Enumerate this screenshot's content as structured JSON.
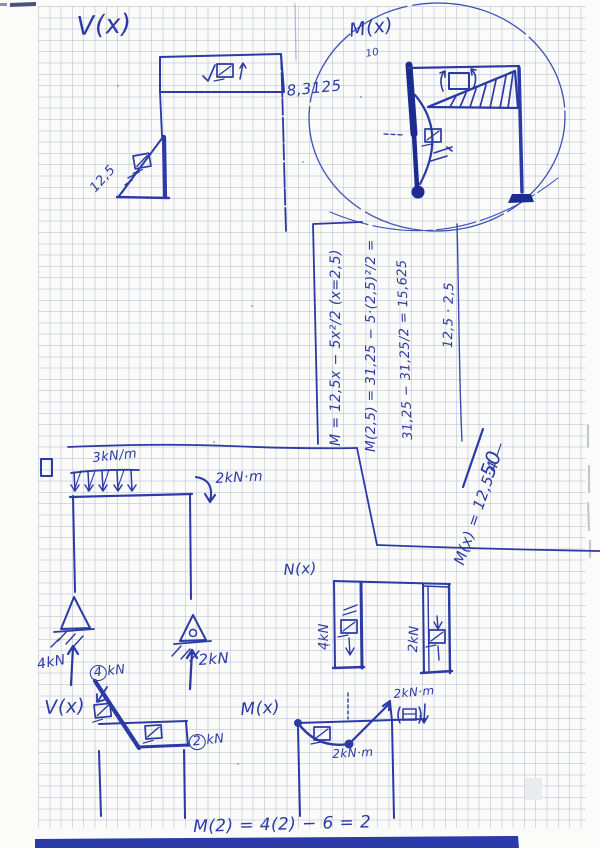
{
  "colors": {
    "ink": "#2b3aa5",
    "ink_heavy": "#1d2b90",
    "grid": "#96a4c4",
    "paper": "#fbfbf9",
    "band": "#2b3caa"
  },
  "top_shear_diagram": {
    "title": "V(x)",
    "beam_value": "8,3125",
    "column_value": "12,5"
  },
  "frame_sketch": {
    "title": "M(x)",
    "tick_label": "10"
  },
  "calculations": {
    "line1": "M = 12,5x − 5x²/2   (x=2,5)",
    "line2": "M(2,5) = 31,25 − 5·(2,5)²/2 =",
    "line3": "31,25 − 31,25/2 = 15,625",
    "line4": "12,5 · 2,5",
    "line5": "M(x) = 12,5·4 —",
    "line5_result": "50"
  },
  "frame_problem": {
    "distributed_load": "3kN/m",
    "applied_moment": "2kN·m",
    "left_reaction": "4kN",
    "right_reaction": "2kN"
  },
  "shear_diagram": {
    "title": "V(x)",
    "start_value": "4",
    "start_unit": "kN",
    "end_value": "2",
    "end_unit": "kN"
  },
  "moment_diagram": {
    "title": "M(x)",
    "sag_value": "2kN·m",
    "peak_value": "2kN·m"
  },
  "axial_diagram": {
    "title": "N(x)",
    "left_value": "4kN",
    "right_value": "2kN"
  },
  "footer": {
    "equation": "M(2) = 4(2) − 6 = 2"
  }
}
